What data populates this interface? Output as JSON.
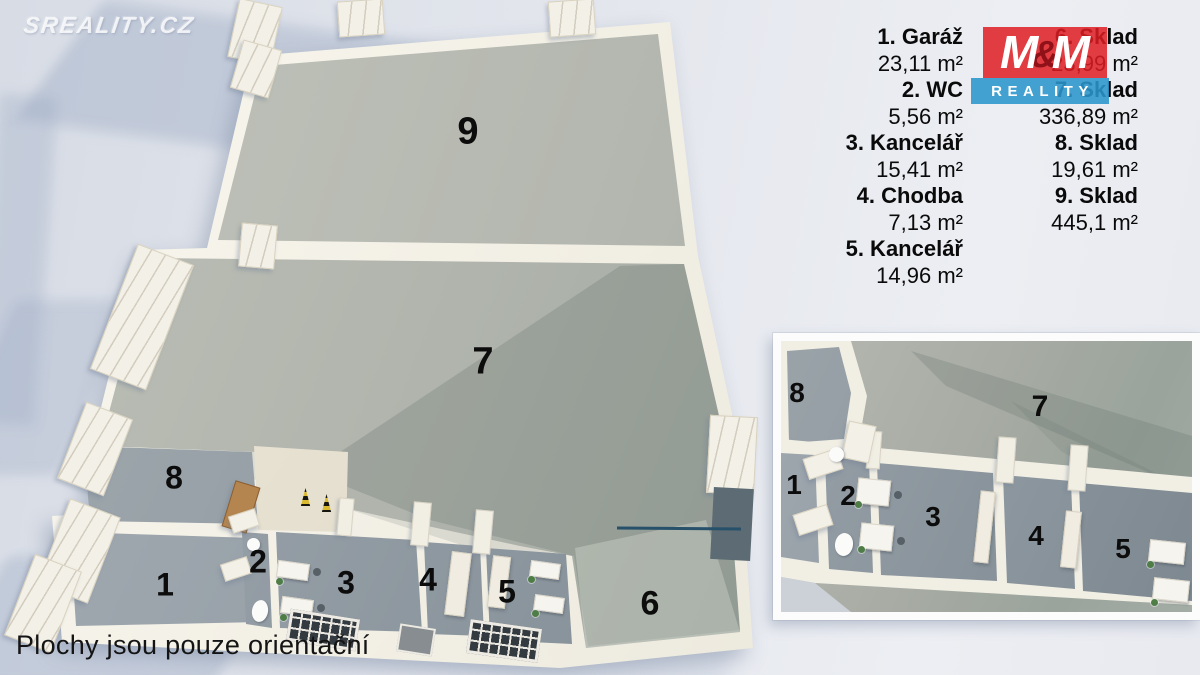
{
  "watermark": {
    "text": "SREALITY.CZ"
  },
  "footer": {
    "note": "Plochy jsou pouze orientační"
  },
  "legend": {
    "items": [
      {
        "number": "1",
        "label": "1. Garáž",
        "area": "23,11 m²"
      },
      {
        "number": "2",
        "label": "2. WC",
        "area": "5,56 m²"
      },
      {
        "number": "3",
        "label": "3. Kancelář",
        "area": "15,41 m²"
      },
      {
        "number": "4",
        "label": "4. Chodba",
        "area": "7,13 m²"
      },
      {
        "number": "5",
        "label": "5. Kancelář",
        "area": "14,96 m²"
      },
      {
        "number": "6",
        "label": "6. Sklad",
        "area": "23,99 m²"
      },
      {
        "number": "7",
        "label": "7. Sklad",
        "area": "336,89 m²"
      },
      {
        "number": "8",
        "label": "8. Sklad",
        "area": "19,61 m²"
      },
      {
        "number": "9",
        "label": "9. Sklad",
        "area": "445,1 m²"
      }
    ]
  },
  "logo": {
    "name": "M&M REALITY",
    "m1": "M",
    "amp": "&",
    "m2": "M",
    "band": "REALITY",
    "colors": {
      "red": "#de1c22",
      "blue": "#2a96cc",
      "amp_dark": "#8c0f16"
    }
  },
  "inset": {
    "labels": [
      "8",
      "7",
      "1",
      "2",
      "3",
      "4",
      "5"
    ]
  },
  "colors": {
    "background": "#e2e5ec",
    "wall": "#f1eee4",
    "floor_large": "#b0b4ac",
    "floor_small": "#8a949c",
    "annotation_line": "#27506a"
  }
}
